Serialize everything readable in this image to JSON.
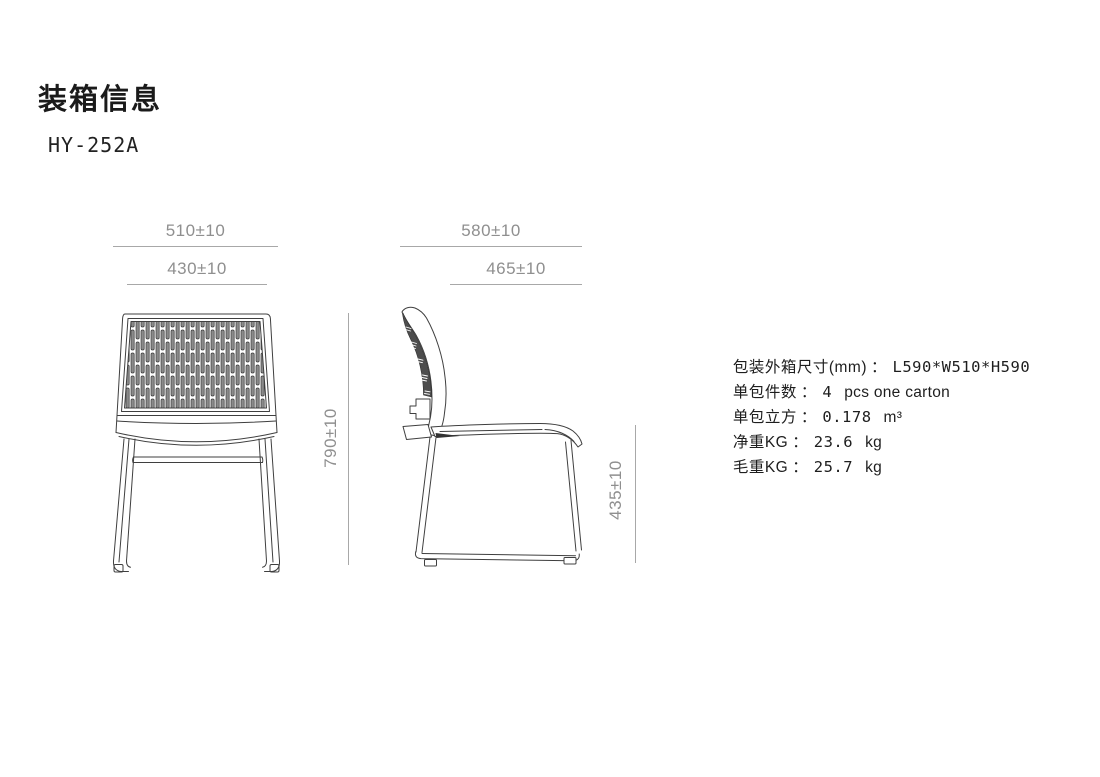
{
  "header": {
    "title": "装箱信息",
    "model": "HY-252A"
  },
  "front_view": {
    "dims": {
      "outer_width": "510±10",
      "inner_width": "430±10",
      "height": "790±10"
    }
  },
  "side_view": {
    "dims": {
      "outer_depth": "580±10",
      "inner_depth": "465±10",
      "height": "435±10"
    }
  },
  "specs": {
    "rows": [
      {
        "label": "包装外箱尺寸(mm)",
        "colon": "：",
        "value": "L590*W510*H590",
        "suffix": ""
      },
      {
        "label": "单包件数",
        "colon": "：",
        "value": "4",
        "suffix": "pcs one carton"
      },
      {
        "label": "单包立方",
        "colon": "：",
        "value": "0.178",
        "suffix": "m³"
      },
      {
        "label": "净重KG",
        "colon": "：",
        "value": "23.6",
        "suffix": "kg"
      },
      {
        "label": "毛重KG",
        "colon": "：",
        "value": "25.7",
        "suffix": "kg"
      }
    ]
  },
  "colors": {
    "line": "#3f3f3f",
    "dark_fill": "#4d4d4d",
    "dim_gray": "#8f8f8f",
    "text": "#1e1e1e"
  }
}
